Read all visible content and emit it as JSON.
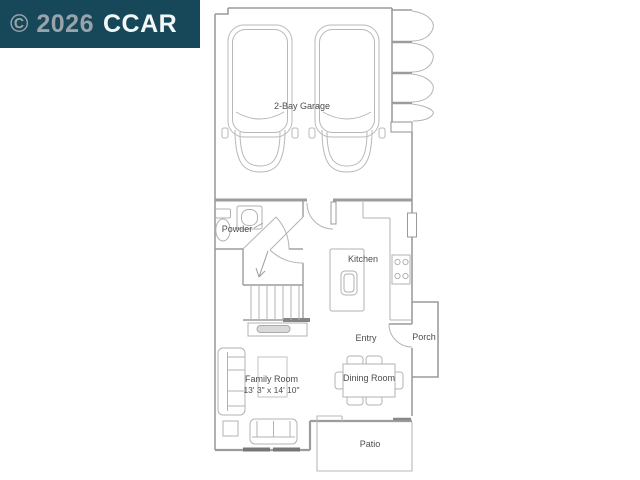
{
  "watermark": {
    "year": "© 2026",
    "brand": "CCAR"
  },
  "colors": {
    "watermark_bg": "#17485A",
    "watermark_year_text": "#9AA3A9",
    "watermark_brand_text": "#F4F7F7",
    "wall_line": "#9C9C9C",
    "furniture_line": "#B3B3B3",
    "label_text": "#4D4D4D"
  },
  "labels": {
    "garage": "2-Bay Garage",
    "powder": "Powder",
    "kitchen": "Kitchen",
    "entry": "Entry",
    "porch": "Porch",
    "dining_room": "Dining Room",
    "family_room": "Family Room",
    "family_room_dims": "13' 3\" x 14' 10\"",
    "patio": "Patio"
  }
}
